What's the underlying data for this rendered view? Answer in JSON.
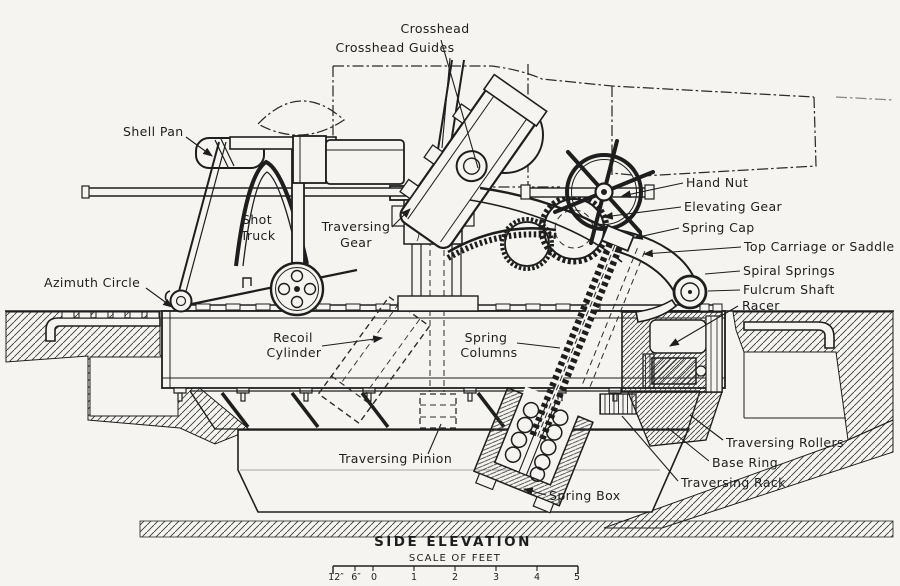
{
  "drawing": {
    "title": "SIDE ELEVATION",
    "scale_label": "SCALE OF FEET",
    "scale_ticks": [
      "12″",
      "6″",
      "0",
      "1",
      "2",
      "3",
      "4",
      "5"
    ]
  },
  "labels": {
    "crosshead": "Crosshead",
    "crosshead_guides": "Crosshead Guides",
    "shell_pan": "Shell Pan",
    "shot_truck_line1": "Shot",
    "shot_truck_line2": "Truck",
    "traversing_gear_line1": "Traversing",
    "traversing_gear_line2": "Gear",
    "hand_nut": "Hand Nut",
    "elevating_gear": "Elevating Gear",
    "spring_cap": "Spring Cap",
    "top_carriage": "Top Carriage or Saddle",
    "spiral_springs": "Spiral Springs",
    "fulcrum_shaft": "Fulcrum Shaft",
    "racer": "Racer",
    "azimuth_circle": "Azimuth Circle",
    "recoil_cylinder_line1": "Recoil",
    "recoil_cylinder_line2": "Cylinder",
    "spring_columns_line1": "Spring",
    "spring_columns_line2": "Columns",
    "traversing_rollers": "Traversing Rollers",
    "base_ring": "Base Ring",
    "traversing_rack": "Traversing Rack",
    "traversing_pinion": "Traversing Pinion",
    "spring_box": "Spring Box"
  },
  "colors": {
    "paper": "#f5f4f0",
    "ink": "#1e1e1e"
  }
}
